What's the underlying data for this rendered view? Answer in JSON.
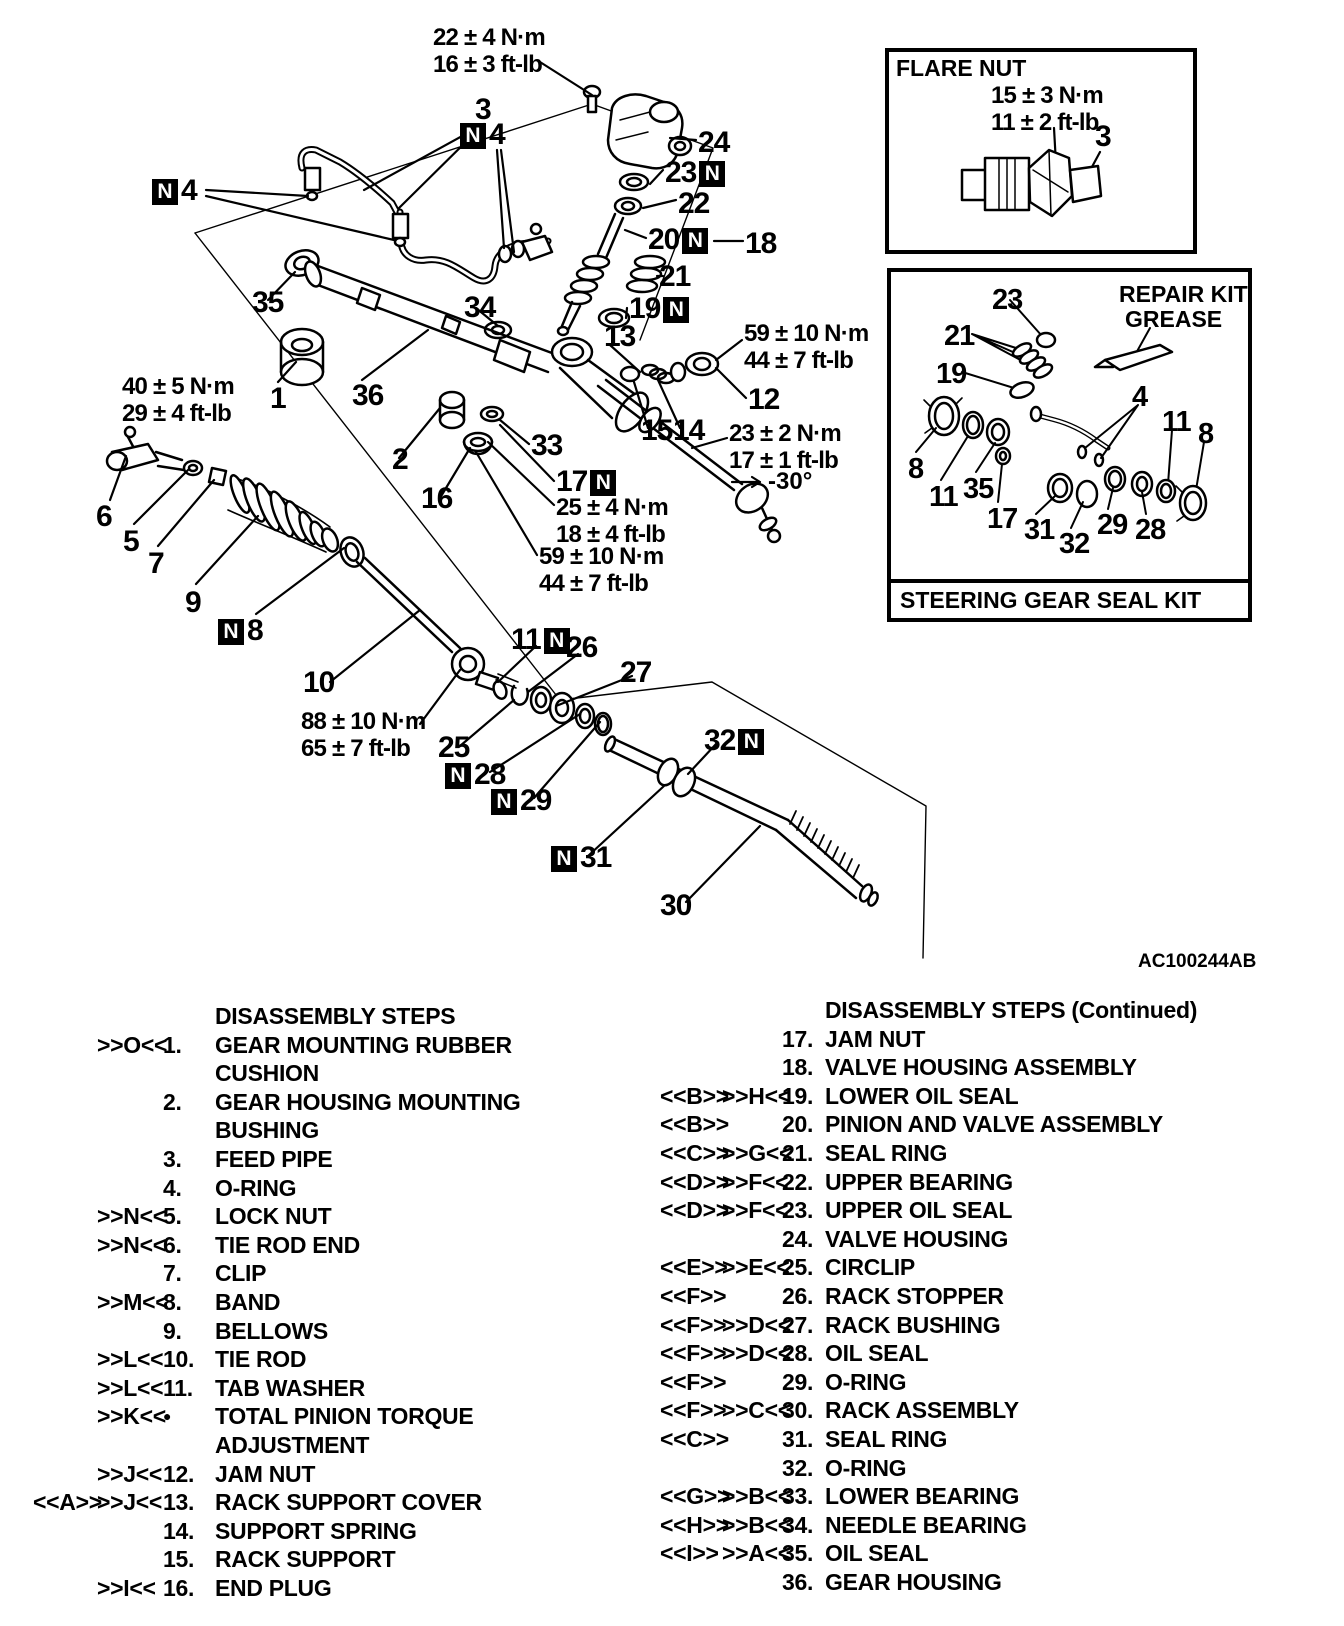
{
  "figure": {
    "code": "AC100244AB",
    "note_symbol": "N",
    "angle_note": "-30°",
    "callouts": [
      {
        "t": "3",
        "x": 475,
        "y": 95
      },
      {
        "t": "4",
        "box": "pre",
        "x": 460,
        "y": 120
      },
      {
        "t": "4",
        "box": "pre",
        "x": 152,
        "y": 176
      },
      {
        "t": "24",
        "x": 698,
        "y": 128
      },
      {
        "t": "23",
        "box": "post",
        "x": 665,
        "y": 158
      },
      {
        "t": "22",
        "x": 678,
        "y": 189
      },
      {
        "t": "20",
        "box": "post",
        "x": 648,
        "y": 225
      },
      {
        "t": "18",
        "x": 745,
        "y": 229
      },
      {
        "t": "21",
        "x": 659,
        "y": 262
      },
      {
        "t": "19",
        "box": "post",
        "x": 629,
        "y": 294
      },
      {
        "t": "13",
        "x": 604,
        "y": 322
      },
      {
        "t": "35",
        "x": 252,
        "y": 288
      },
      {
        "t": "34",
        "x": 464,
        "y": 293
      },
      {
        "t": "12",
        "x": 748,
        "y": 385
      },
      {
        "t": "1",
        "x": 270,
        "y": 384
      },
      {
        "t": "36",
        "x": 352,
        "y": 381
      },
      {
        "t": "15",
        "x": 641,
        "y": 416
      },
      {
        "t": "14",
        "x": 673,
        "y": 416
      },
      {
        "t": "2",
        "x": 392,
        "y": 445
      },
      {
        "t": "33",
        "x": 531,
        "y": 431
      },
      {
        "t": "16",
        "x": 421,
        "y": 484
      },
      {
        "t": "17",
        "box": "post",
        "x": 556,
        "y": 467
      },
      {
        "t": "6",
        "x": 96,
        "y": 502
      },
      {
        "t": "5",
        "x": 123,
        "y": 527
      },
      {
        "t": "7",
        "x": 148,
        "y": 549
      },
      {
        "t": "9",
        "x": 185,
        "y": 588
      },
      {
        "t": "8",
        "box": "pre",
        "x": 218,
        "y": 616
      },
      {
        "t": "10",
        "x": 303,
        "y": 668
      },
      {
        "t": "11",
        "box": "post",
        "x": 511,
        "y": 625
      },
      {
        "t": "26",
        "x": 566,
        "y": 633
      },
      {
        "t": "27",
        "x": 620,
        "y": 658
      },
      {
        "t": "25",
        "x": 438,
        "y": 733
      },
      {
        "t": "28",
        "box": "pre",
        "x": 445,
        "y": 760
      },
      {
        "t": "29",
        "box": "pre",
        "x": 491,
        "y": 786
      },
      {
        "t": "32",
        "box": "post",
        "x": 704,
        "y": 726
      },
      {
        "t": "31",
        "box": "pre",
        "x": 551,
        "y": 843
      },
      {
        "t": "30",
        "x": 660,
        "y": 891
      }
    ],
    "torque_notes": [
      {
        "l1": "22 ± 4 N·m",
        "l2": "16 ± 3 ft-lb",
        "x": 433,
        "y": 24
      },
      {
        "l1": "40 ± 5 N·m",
        "l2": "29 ± 4 ft-lb",
        "x": 122,
        "y": 373
      },
      {
        "l1": "59 ± 10 N·m",
        "l2": "44 ± 7 ft-lb",
        "x": 744,
        "y": 320
      },
      {
        "l1": "23 ± 2 N·m",
        "l2": "17 ± 1 ft-lb",
        "x": 729,
        "y": 420
      },
      {
        "l1": "25 ± 4 N·m",
        "l2": "18 ± 4 ft-lb",
        "x": 556,
        "y": 494
      },
      {
        "l1": "59 ± 10 N·m",
        "l2": "44 ± 7 ft-lb",
        "x": 539,
        "y": 543
      },
      {
        "l1": "88 ± 10 N·m",
        "l2": "65 ± 7 ft-lb",
        "x": 301,
        "y": 708
      }
    ]
  },
  "flare_box": {
    "title": "FLARE NUT",
    "t1": "15 ± 3 N·m",
    "t2": "11 ± 2 ft-lb",
    "part_label": "3"
  },
  "seal_box": {
    "note1": "REPAIR KIT",
    "note2": "GREASE",
    "footer": "STEERING GEAR SEAL KIT",
    "labels": [
      {
        "t": "23",
        "x": 992,
        "y": 286
      },
      {
        "t": "21",
        "x": 944,
        "y": 322
      },
      {
        "t": "19",
        "x": 936,
        "y": 360
      },
      {
        "t": "4",
        "x": 1132,
        "y": 383
      },
      {
        "t": "11",
        "x": 1162,
        "y": 408
      },
      {
        "t": "8",
        "x": 1198,
        "y": 420
      },
      {
        "t": "8",
        "x": 908,
        "y": 455
      },
      {
        "t": "11",
        "x": 929,
        "y": 483
      },
      {
        "t": "35",
        "x": 963,
        "y": 475
      },
      {
        "t": "17",
        "x": 987,
        "y": 505
      },
      {
        "t": "31",
        "x": 1024,
        "y": 516
      },
      {
        "t": "32",
        "x": 1059,
        "y": 530
      },
      {
        "t": "29",
        "x": 1097,
        "y": 511
      },
      {
        "t": "28",
        "x": 1135,
        "y": 516
      }
    ]
  },
  "steps_left": {
    "header": "DISASSEMBLY STEPS",
    "items": [
      {
        "a": "",
        "b": ">>O<<",
        "n": "1.",
        "t": "GEAR MOUNTING RUBBER CUSHION"
      },
      {
        "a": "",
        "b": "",
        "n": "2.",
        "t": "GEAR HOUSING MOUNTING BUSHING"
      },
      {
        "a": "",
        "b": "",
        "n": "3.",
        "t": "FEED PIPE"
      },
      {
        "a": "",
        "b": "",
        "n": "4.",
        "t": "O-RING"
      },
      {
        "a": "",
        "b": ">>N<<",
        "n": "5.",
        "t": "LOCK NUT"
      },
      {
        "a": "",
        "b": ">>N<<",
        "n": "6.",
        "t": "TIE ROD END"
      },
      {
        "a": "",
        "b": "",
        "n": "7.",
        "t": "CLIP"
      },
      {
        "a": "",
        "b": ">>M<<",
        "n": "8.",
        "t": "BAND"
      },
      {
        "a": "",
        "b": "",
        "n": "9.",
        "t": "BELLOWS"
      },
      {
        "a": "",
        "b": ">>L<<",
        "n": "10.",
        "t": "TIE ROD"
      },
      {
        "a": "",
        "b": ">>L<<",
        "n": "11.",
        "t": "TAB WASHER"
      },
      {
        "a": "",
        "b": ">>K<<",
        "n": "●",
        "t": "TOTAL PINION TORQUE ADJUSTMENT"
      },
      {
        "a": "",
        "b": ">>J<<",
        "n": "12.",
        "t": "JAM NUT"
      },
      {
        "a": "<<A>>",
        "b": ">>J<<",
        "n": "13.",
        "t": "RACK SUPPORT COVER"
      },
      {
        "a": "",
        "b": "",
        "n": "14.",
        "t": "SUPPORT SPRING"
      },
      {
        "a": "",
        "b": "",
        "n": "15.",
        "t": "RACK SUPPORT"
      },
      {
        "a": "",
        "b": ">>I<<",
        "n": "16.",
        "t": "END PLUG"
      }
    ]
  },
  "steps_right": {
    "header": "DISASSEMBLY STEPS (Continued)",
    "items": [
      {
        "a": "",
        "b": "",
        "n": "17.",
        "t": "JAM NUT"
      },
      {
        "a": "",
        "b": "",
        "n": "18.",
        "t": "VALVE HOUSING ASSEMBLY"
      },
      {
        "a": "<<B>>",
        "b": ">>H<<",
        "n": "19.",
        "t": "LOWER OIL SEAL"
      },
      {
        "a": "<<B>>",
        "b": "",
        "n": "20.",
        "t": "PINION AND VALVE ASSEMBLY"
      },
      {
        "a": "<<C>>",
        "b": ">>G<<",
        "n": "21.",
        "t": "SEAL RING"
      },
      {
        "a": "<<D>>",
        "b": ">>F<<",
        "n": "22.",
        "t": "UPPER BEARING"
      },
      {
        "a": "<<D>>",
        "b": ">>F<<",
        "n": "23.",
        "t": "UPPER OIL SEAL"
      },
      {
        "a": "",
        "b": "",
        "n": "24.",
        "t": "VALVE HOUSING"
      },
      {
        "a": "<<E>>",
        "b": ">>E<<",
        "n": "25.",
        "t": "CIRCLIP"
      },
      {
        "a": "<<F>>",
        "b": "",
        "n": "26.",
        "t": "RACK STOPPER"
      },
      {
        "a": "<<F>>",
        "b": ">>D<<",
        "n": "27.",
        "t": "RACK BUSHING"
      },
      {
        "a": "<<F>>",
        "b": ">>D<<",
        "n": "28.",
        "t": "OIL SEAL"
      },
      {
        "a": "<<F>>",
        "b": "",
        "n": "29.",
        "t": "O-RING"
      },
      {
        "a": "<<F>>",
        "b": ">>C<<",
        "n": "30.",
        "t": "RACK ASSEMBLY"
      },
      {
        "a": "<<C>>",
        "b": "",
        "n": "31.",
        "t": "SEAL RING"
      },
      {
        "a": "",
        "b": "",
        "n": "32.",
        "t": "O-RING"
      },
      {
        "a": "<<G>>",
        "b": ">>B<<",
        "n": "33.",
        "t": "LOWER BEARING"
      },
      {
        "a": "<<H>>",
        "b": ">>B<<",
        "n": "34.",
        "t": "NEEDLE BEARING"
      },
      {
        "a": "<<I>>",
        "b": ">>A<<",
        "n": "35.",
        "t": "OIL SEAL"
      },
      {
        "a": "",
        "b": "",
        "n": "36.",
        "t": "GEAR HOUSING"
      }
    ]
  }
}
